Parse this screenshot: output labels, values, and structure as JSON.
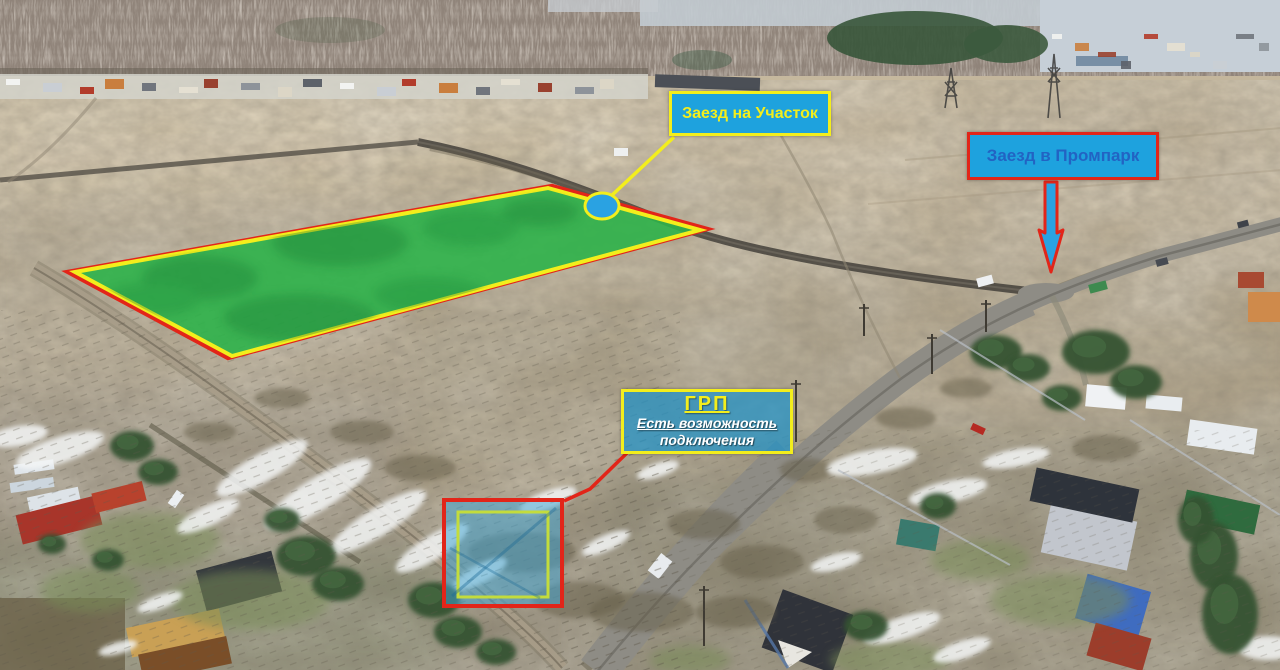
{
  "labels": {
    "plot_entrance": {
      "text": "Заезд на Участок"
    },
    "prompark_entrance": {
      "text": "Заезд в Промпарк"
    },
    "grp": {
      "title": "ГРП",
      "line1": "Есть возможность",
      "line2": "подключения"
    }
  },
  "colors": {
    "callout_cyan": "#1ea2de",
    "callout_yellow": "#f3ee1c",
    "callout_red": "#e22519",
    "prompark_text": "#2263c3",
    "plot_green": "#2eb24a",
    "marker_blue": "#2aa2e2",
    "grp_site_fill": "#3ba6d8",
    "grp_site_inner_border": "#c3dc3c"
  }
}
